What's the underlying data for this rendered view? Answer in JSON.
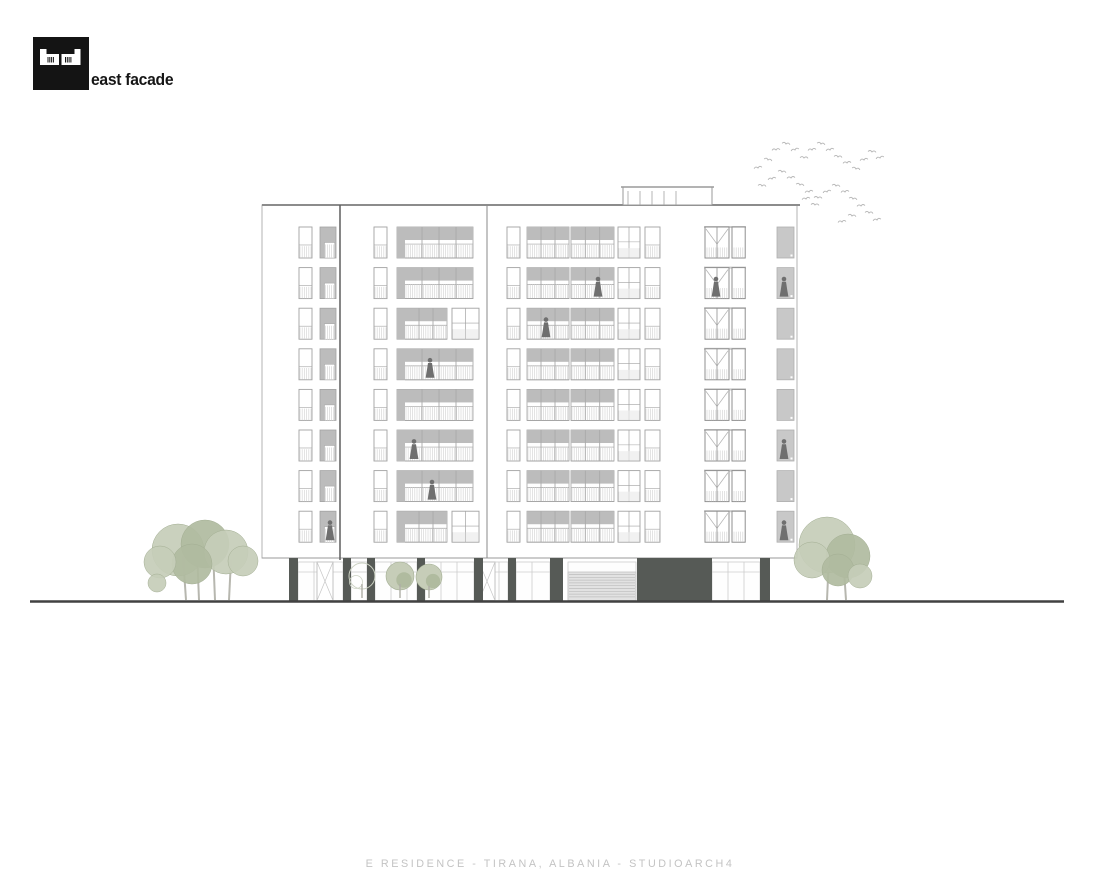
{
  "header": {
    "title": "east facade",
    "logo_name": "studioarch4-logo"
  },
  "footer": {
    "caption": "E RESIDENCE - TIRANA, ALBANIA - STUDIOARCH4"
  },
  "drawing": {
    "colors": {
      "line": "#a2a2a2",
      "line_dark": "#6d6d6d",
      "frame": "#8f8f8f",
      "gray_fill": "#bcbcbc",
      "gray_light": "#c9c9c9",
      "railing": "#d7d7d7",
      "dark": "#565a56",
      "figure": "#6f6f6f",
      "glass_line": "#cccccc",
      "tree_fill1": "#c6cdb8",
      "tree_fill2": "#b0bb9f",
      "tree_line": "#a3ae93",
      "trunk": "#b7b7af",
      "bird": "#b5b5b5",
      "ground": "#414141",
      "white": "#ffffff"
    },
    "ground_line": {
      "x1": 30,
      "x2": 1064,
      "y": 601.5,
      "width": 2.4
    },
    "facade": {
      "x": 262,
      "y": 205,
      "w": 535,
      "h": 353,
      "dividers": [
        340,
        487
      ]
    },
    "roof_box": {
      "x": 623,
      "y": 187,
      "w": 89,
      "h": 18,
      "mullions": [
        628,
        640,
        652,
        664,
        676
      ]
    },
    "floors": {
      "count": 8,
      "top": 227,
      "pitch": 40.6,
      "win_h": 31
    },
    "modules": {
      "all": [
        {
          "type": "window",
          "x": 299,
          "w": 13
        },
        {
          "type": "panelgray",
          "x": 320,
          "w": 16
        },
        {
          "type": "window",
          "x": 374,
          "w": 13
        },
        {
          "type": "window",
          "x": 507,
          "w": 13
        },
        {
          "type": "balcony",
          "x": 527,
          "w": 42,
          "bays": 3
        },
        {
          "type": "balcony",
          "x": 571,
          "w": 43,
          "bays": 3
        },
        {
          "type": "windowgrid",
          "x": 618,
          "w": 22
        },
        {
          "type": "window",
          "x": 645,
          "w": 15
        },
        {
          "type": "frenchdoor",
          "x": 705,
          "w": 40
        },
        {
          "type": "elevator",
          "x": 777,
          "w": 17
        }
      ],
      "mid_default": [
        {
          "type": "balcony",
          "x": 397,
          "w": 76,
          "bays": 4,
          "grayLeft": 8
        }
      ],
      "mid_split": [
        {
          "type": "balcony",
          "x": 397,
          "w": 50,
          "bays": 3,
          "grayLeft": 8
        },
        {
          "type": "windowgrid",
          "x": 452,
          "w": 27
        }
      ],
      "split_floors": [
        2,
        7
      ]
    },
    "figures": [
      [
        1,
        598
      ],
      [
        1,
        716
      ],
      [
        1,
        784
      ],
      [
        2,
        546
      ],
      [
        3,
        430
      ],
      [
        5,
        414
      ],
      [
        5,
        784
      ],
      [
        6,
        432
      ],
      [
        7,
        330
      ],
      [
        7,
        784
      ]
    ],
    "ground_floor": {
      "top": 558,
      "bottom": 600.5,
      "glass_top": 562,
      "transom": 572,
      "columns": [
        [
          289,
          9
        ],
        [
          343,
          8
        ],
        [
          367,
          8
        ],
        [
          417,
          8
        ],
        [
          474,
          9
        ],
        [
          508,
          8
        ],
        [
          550,
          13
        ],
        [
          760,
          10
        ]
      ],
      "glass_runs": [
        [
          298,
          45
        ],
        [
          351,
          16
        ],
        [
          375,
          42
        ],
        [
          425,
          49
        ],
        [
          483,
          25
        ],
        [
          516,
          34
        ],
        [
          712,
          48
        ]
      ],
      "shutter": {
        "x": 568,
        "w": 68
      },
      "dark_block": {
        "x": 637,
        "w": 75
      },
      "doors": [
        [
          317,
          16
        ],
        [
          479,
          16
        ]
      ]
    },
    "trees": [
      {
        "blobs": [
          [
            178,
            550,
            26,
            1
          ],
          [
            205,
            544,
            24,
            2
          ],
          [
            226,
            552,
            22,
            1
          ],
          [
            243,
            561,
            15,
            1
          ],
          [
            192,
            564,
            20,
            2
          ],
          [
            160,
            562,
            16,
            1
          ],
          [
            157,
            583,
            9,
            1
          ]
        ],
        "trunks": [
          [
            186,
            600,
            183,
            556
          ],
          [
            199,
            600,
            197,
            550
          ],
          [
            215,
            600,
            213,
            550
          ],
          [
            229,
            600,
            231,
            560
          ]
        ]
      },
      {
        "blobs": [
          [
            827,
            545,
            28,
            1
          ],
          [
            848,
            556,
            22,
            2
          ],
          [
            812,
            560,
            18,
            1
          ],
          [
            838,
            570,
            16,
            2
          ],
          [
            860,
            576,
            12,
            1
          ]
        ],
        "trunks": [
          [
            827,
            600,
            829,
            556
          ],
          [
            846,
            600,
            844,
            570
          ]
        ]
      }
    ],
    "bushes": {
      "sketch": [
        362,
        576,
        13
      ],
      "green": [
        [
          400,
          576,
          14
        ],
        [
          429,
          577,
          13
        ]
      ],
      "trunks": [
        [
          400,
          598,
          400,
          584
        ],
        [
          429,
          598,
          429,
          586
        ],
        [
          362,
          598,
          362,
          584
        ]
      ]
    },
    "birds": [
      [
        758,
        168,
        -10
      ],
      [
        768,
        160,
        15
      ],
      [
        776,
        150,
        -5
      ],
      [
        786,
        144,
        10
      ],
      [
        795,
        150,
        -15
      ],
      [
        804,
        158,
        5
      ],
      [
        812,
        150,
        -8
      ],
      [
        821,
        144,
        12
      ],
      [
        830,
        150,
        -12
      ],
      [
        838,
        157,
        8
      ],
      [
        847,
        163,
        -6
      ],
      [
        856,
        169,
        14
      ],
      [
        864,
        160,
        -10
      ],
      [
        872,
        152,
        6
      ],
      [
        880,
        158,
        -14
      ],
      [
        762,
        186,
        8
      ],
      [
        772,
        179,
        -12
      ],
      [
        782,
        172,
        10
      ],
      [
        791,
        178,
        -6
      ],
      [
        800,
        185,
        12
      ],
      [
        809,
        192,
        -10
      ],
      [
        818,
        198,
        6
      ],
      [
        827,
        192,
        -14
      ],
      [
        836,
        186,
        10
      ],
      [
        845,
        192,
        -8
      ],
      [
        853,
        199,
        12
      ],
      [
        861,
        206,
        -6
      ],
      [
        869,
        213,
        8
      ],
      [
        877,
        220,
        -12
      ],
      [
        852,
        216,
        10
      ],
      [
        842,
        222,
        -8
      ],
      [
        815,
        205,
        6
      ],
      [
        806,
        199,
        -10
      ]
    ]
  }
}
